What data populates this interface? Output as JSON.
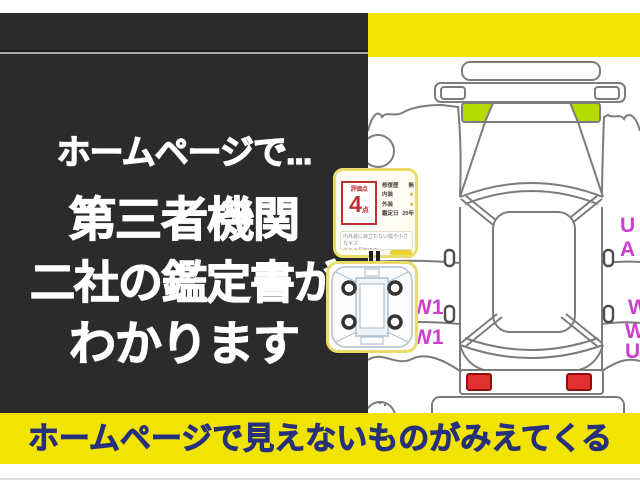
{
  "headline": {
    "line1": "ホームページで...",
    "line2": "第三者機関",
    "line3": "二社の鑑定書が",
    "line4": "わかります"
  },
  "banner": {
    "text": "ホームページで見えないものがみえてくる"
  },
  "certificate": {
    "score_label": "評価点",
    "score_value": "4",
    "score_unit": "点",
    "rows": [
      {
        "label": "修復歴",
        "value": "無"
      },
      {
        "label": "内装",
        "value": "★"
      },
      {
        "label": "外装",
        "value": "★"
      },
      {
        "label": "鑑定日",
        "value": "20年"
      }
    ],
    "note_line1": "内外装に目立たない傷や小さなキズ",
    "note_line2": "られる程度です。"
  },
  "damage_codes": {
    "left_side": [
      "W1",
      "W1"
    ],
    "right_upper": [
      "U",
      "A"
    ],
    "right_lower": [
      "W",
      "W",
      "U"
    ]
  },
  "colors": {
    "frame_yellow": "#F0E400",
    "panel_black": "#2B2B2B",
    "banner_text_navy": "#27307A",
    "highlight_green": "#B4DC00",
    "taillight_red": "#E03030",
    "damage_magenta": "#CC3FCC",
    "score_red": "#C03030",
    "star_gold": "#D9A800"
  }
}
